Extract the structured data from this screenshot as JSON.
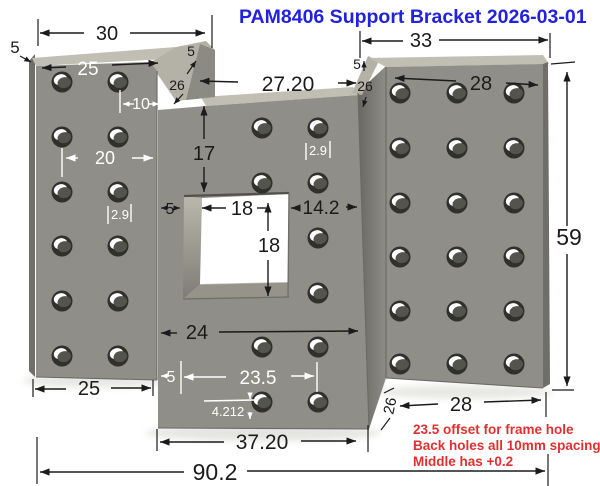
{
  "title": {
    "text": "PAM8406 Support Bracket 2026-03-01",
    "color": "#2222dd"
  },
  "notes": {
    "color": "#e23030",
    "lines": [
      "23.5 offset for frame hole",
      "Back holes all 10mm spacing",
      "Middle has +0.2"
    ]
  },
  "part": {
    "body_color": "#8f8e88",
    "bevel_color": "#c1beb4",
    "notch_color": "#b4b1a7",
    "side_color": "#6f6e68",
    "wall_color": "#8b8a83",
    "hole": {
      "rim": "#30302c",
      "bore": "#54544e",
      "highlight": "#ffffff"
    },
    "hole_grids": {
      "left": {
        "cols": [
          62,
          118
        ],
        "rows": [
          82,
          137,
          192,
          246,
          301,
          356
        ]
      },
      "center": {
        "cols": [
          262,
          318
        ],
        "rows": [
          128,
          183,
          238,
          293,
          347,
          402
        ],
        "skip": [
          [
            0,
            2
          ],
          [
            0,
            3
          ]
        ]
      },
      "right": {
        "cols": [
          400,
          457,
          514
        ],
        "rows": [
          93,
          148,
          203,
          257,
          311,
          364
        ]
      }
    }
  },
  "dims": {
    "thickness_tl": "5",
    "top_left_width": "30",
    "left_holes_width": "25",
    "left_notch_5": "5",
    "left_notch_26": "26",
    "hole_pitch_10": "10",
    "center_top_width": "27.20",
    "left_pitch_20": "20",
    "left_offset_29": "2.9",
    "center_top_height": "17",
    "center_offset_29": "2.9",
    "hole_edge_5": "5",
    "window_width_18": "18",
    "window_height_18": "18",
    "right_of_window_142": "14.2",
    "center_width_24": "24",
    "left_bottom_25": "25",
    "bottom_edge_5": "5",
    "frame_offset_235": "23.5",
    "bottom_offset_4212": "4.212",
    "center_total_width_3720": "37.20",
    "overall_width_902": "90.2",
    "right_top_width_33": "33",
    "right_notch_5": "5",
    "right_notch_26": "26",
    "right_holes_width_28": "28",
    "overall_height_59": "59",
    "right_bottom_28": "28",
    "fold_depth_26": "26"
  }
}
